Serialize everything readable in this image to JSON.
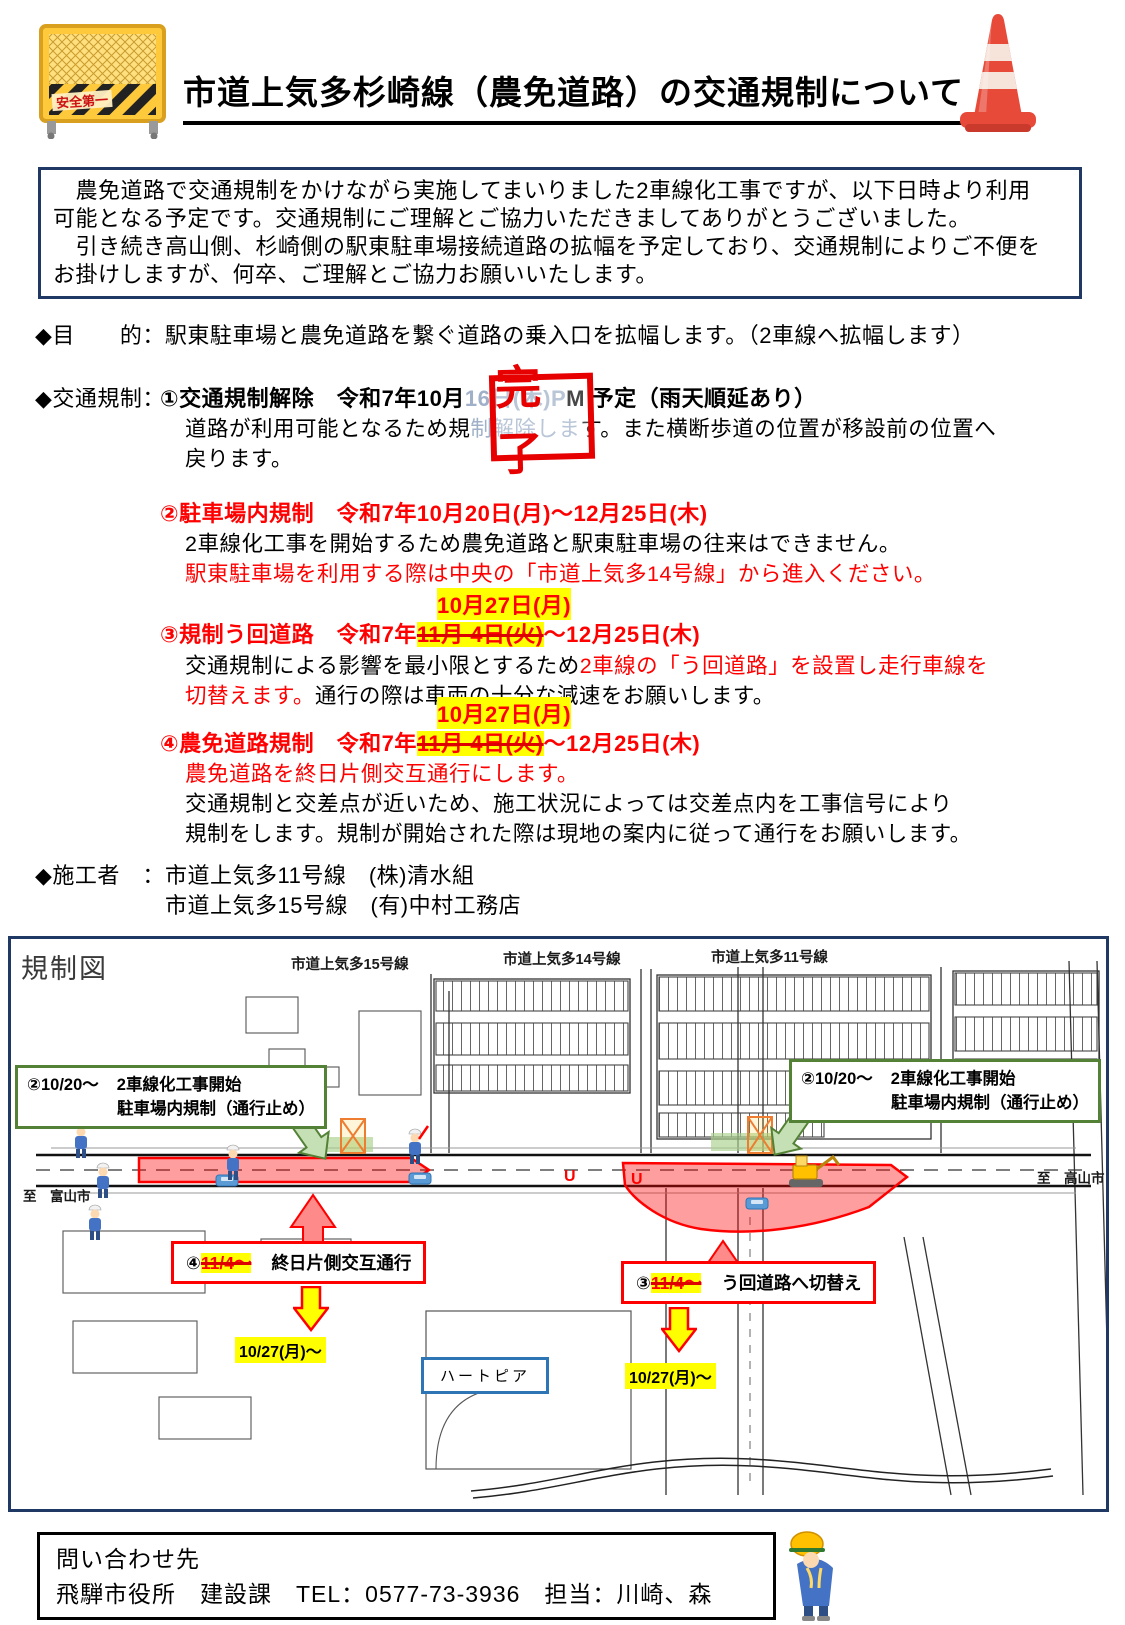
{
  "header": {
    "title": "市道上気多杉崎線（農免道路）の交通規制について",
    "barrier_label": "安全第一",
    "icons": {
      "left": "safety-barrier-fence",
      "right": "traffic-cone"
    }
  },
  "intro": {
    "lines": [
      "　農免道路で交通規制をかけながら実施してまいりました2車線化工事ですが、以下日時より利用",
      "可能となる予定です。交通規制にご理解とご協力いただきましてありがとうございました。",
      "　引き続き高山側、杉崎側の駅東駐車場接続道路の拡幅を予定しており、交通規制によりご不便を",
      "お掛けしますが、何卒、ご理解とご協力お願いいたします。"
    ]
  },
  "purpose": {
    "label": "◆目　　的：",
    "text": "駅東駐車場と農免道路を繋ぐ道路の乗入口を拡幅します。（2車線へ拡幅します）"
  },
  "regulation": {
    "label": "◆交通規制：",
    "item1": {
      "head_pre": "①交通規制解除　令和7年10月",
      "head_hidden": "16日(木)P",
      "head_post": "M 予定（雨天順延あり）",
      "stamp": "完了",
      "body1_pre": "道路が利用可能となるため規",
      "body1_hidden": "制解除しま",
      "body1_post": "す。また横断歩道の位置が移設前の位置へ",
      "body2": "戻ります。"
    },
    "item2": {
      "heading": "②駐車場内規制　令和7年10月20日(月)～12月25日(木)",
      "body1": "2車線化工事を開始するため農免道路と駅東駐車場の往来はできません。",
      "body2": "駅東駐車場を利用する際は中央の「市道上気多14号線」から進入ください。"
    },
    "item3": {
      "new_date": "10月27日(月)",
      "head_pre": "③規制う回道路　令和7年",
      "head_struck": "11月 4日(火)",
      "head_post": "～12月25日(木)",
      "body1_black": "交通規制による影響を最小限とするため",
      "body1_red": "2車線の「う回道路」を設置し走行車線を",
      "body2_red": "切替えます。",
      "body2_black": "通行の際は車両の十分な減速をお願いします。"
    },
    "item4": {
      "new_date": "10月27日(月)",
      "head_pre": "④農免道路規制　令和7年",
      "head_struck": "11月 4日(火)",
      "head_post": "～12月25日(木)",
      "body1": "農免道路を終日片側交互通行にします。",
      "body2": "交通規制と交差点が近いため、施工状況によっては交差点内を工事信号により",
      "body3": "規制をします。規制が開始された際は現地の案内に従って通行をお願いします。"
    }
  },
  "contractor": {
    "label": "◆施工者　：",
    "line1": "市道上気多11号線　(株)清水組",
    "line2": "市道上気多15号線　(有)中村工務店"
  },
  "map": {
    "title": "規制図",
    "road_labels": [
      "市道上気多15号線",
      "市道上気多14号線",
      "市道上気多11号線"
    ],
    "callout_parking_left": {
      "prefix": "②10/20～",
      "line1": "2車線化工事開始",
      "line2": "駐車場内規制（通行止め）"
    },
    "callout_parking_right": {
      "prefix": "②10/20～",
      "line1": "2車線化工事開始",
      "line2": "駐車場内規制（通行止め）"
    },
    "callout_alt": {
      "num": "④",
      "struck_date": "11/4～",
      "text": "終日片側交互通行",
      "new_date": "10/27(月)～"
    },
    "callout_detour": {
      "num": "③",
      "struck_date": "11/4～",
      "text": "う回道路へ切替え",
      "new_date": "10/27(月)～"
    },
    "heartpia_label": "ハートピア",
    "dest_left": "至　富山市",
    "dest_right": "至　高山市",
    "icons": [
      "traffic-worker",
      "excavator",
      "car",
      "down-arrow",
      "up-arrow",
      "green-arrow"
    ]
  },
  "footer": {
    "line1": "問い合わせ先",
    "line2": "飛騨市役所　建設課　TEL：0577-73-3936　担当：川崎、森",
    "icon": "bowing-worker"
  },
  "colors": {
    "accent_red": "#ff0000",
    "highlight_yellow": "#ffff00",
    "navy_border": "#1f3864",
    "green_callout": "#538135",
    "map_blue": "#2e75b6"
  }
}
